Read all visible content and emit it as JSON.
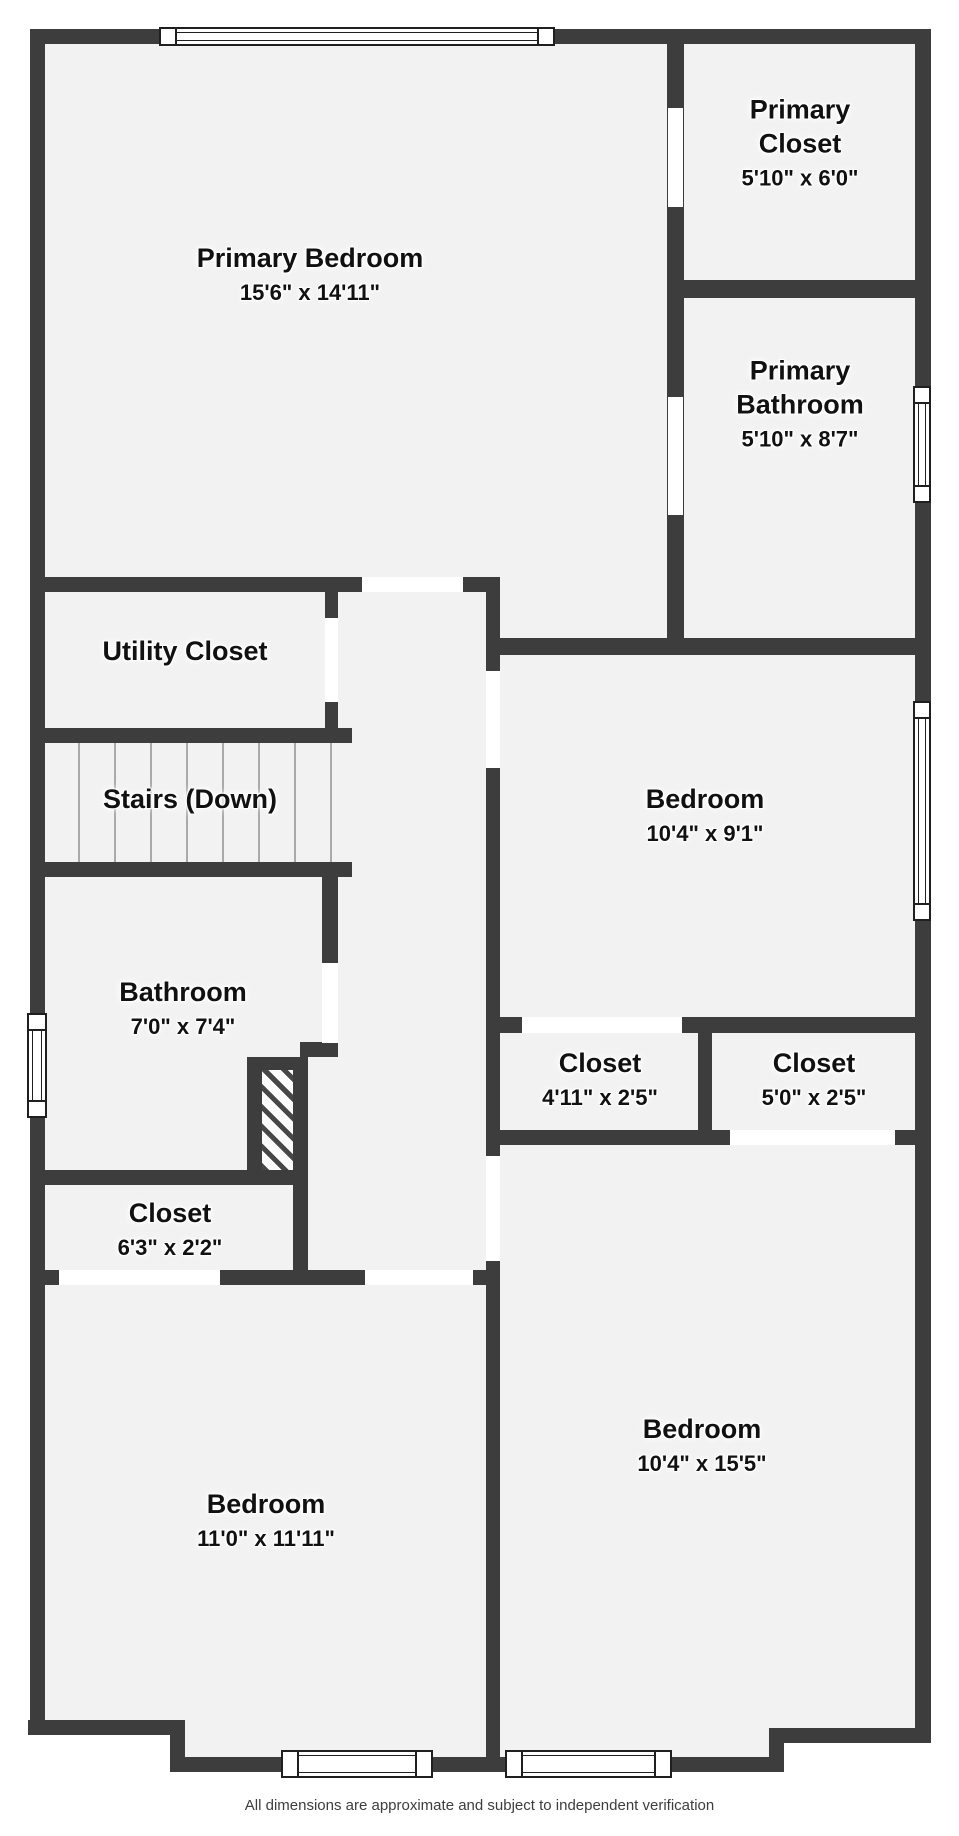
{
  "page": {
    "title": "Floor Plan",
    "footer_disclaimer": "All dimensions are approximate and subject to independent verification"
  },
  "palette": {
    "wall": "#3d3d3d",
    "floor": "#f2f2f2",
    "door_gap": "#ffffff",
    "window_frame": "#1f1f1f",
    "label_text": "#111111",
    "stair_line": "#a9a9a9",
    "hatch_stripe": "#474747",
    "background": "#ffffff"
  },
  "rooms": {
    "primary_bedroom": {
      "name": "Primary Bedroom",
      "dims": "15'6\" x 14'11\""
    },
    "primary_closet": {
      "name": "Primary Closet",
      "dims": "5'10\" x 6'0\""
    },
    "primary_bathroom": {
      "name": "Primary Bathroom",
      "dims": "5'10\" x 8'7\""
    },
    "utility_closet": {
      "name": "Utility Closet"
    },
    "stairs": {
      "name": "Stairs (Down)"
    },
    "bathroom": {
      "name": "Bathroom",
      "dims": "7'0\" x 7'4\""
    },
    "bedroom_middle": {
      "name": "Bedroom",
      "dims": "10'4\" x 9'1\""
    },
    "closet_small_left": {
      "name": "Closet",
      "dims": "4'11\" x 2'5\""
    },
    "closet_small_right": {
      "name": "Closet",
      "dims": "5'0\" x 2'5\""
    },
    "closet_hall": {
      "name": "Closet",
      "dims": "6'3\" x 2'2\""
    },
    "bedroom_bottom_left": {
      "name": "Bedroom",
      "dims": "11'0\" x 11'11\""
    },
    "bedroom_bottom_right": {
      "name": "Bedroom",
      "dims": "10'4\" x 15'5\""
    }
  }
}
